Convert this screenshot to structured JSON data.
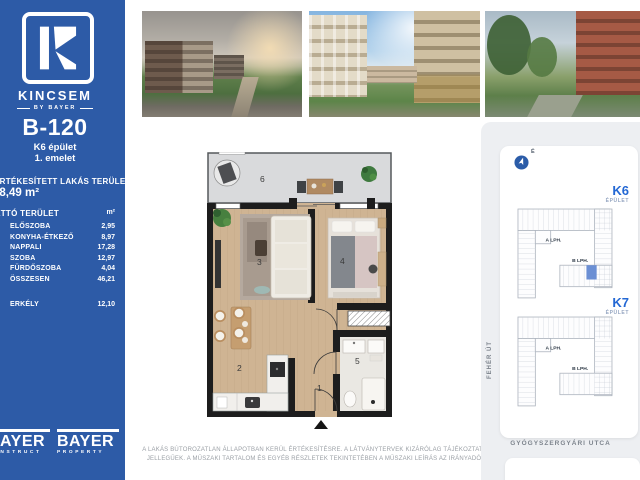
{
  "colors": {
    "sidebar_blue": "#2d5ba7",
    "accent_blue": "#2468d4",
    "unit_highlight": "#6b8fd4",
    "panel_gray": "#edeff2",
    "wall_black": "#1d1d1d",
    "wood_floor": "#cfb493"
  },
  "sidebar": {
    "logo_letter": "K",
    "brand_name": "KINCSEM",
    "brand_tagline": "BY BAYER",
    "unit_id": "B-120",
    "building": "K6 épület",
    "floor": "1. emelet",
    "sold_area_label": "ÉRTÉKESÍTETT LAKÁS TERÜLET",
    "sold_area_value": "48,49 m²",
    "net_table": {
      "header_label": "NETTÓ TERÜLET",
      "header_unit": "m²",
      "rows": [
        {
          "label": "ELŐSZOBA",
          "value": "2,95"
        },
        {
          "label": "KONYHA-ÉTKEZŐ",
          "value": "8,97"
        },
        {
          "label": "NAPPALI",
          "value": "17,28"
        },
        {
          "label": "SZOBA",
          "value": "12,97"
        },
        {
          "label": "FÜRDŐSZOBA",
          "value": "4,04"
        },
        {
          "label": "ÖSSZESEN",
          "value": "46,21"
        },
        {
          "label": "ERKÉLY",
          "value": "12,10"
        }
      ]
    },
    "partner_logos": [
      {
        "name": "BAYER",
        "division": "CONSTRUCT"
      },
      {
        "name": "BAYER",
        "division": "PROPERTY"
      }
    ]
  },
  "gallery": {
    "photos": [
      {
        "name": "park-avenue-render"
      },
      {
        "name": "courtyard-render"
      },
      {
        "name": "street-render"
      }
    ]
  },
  "floor_plan": {
    "rooms": {
      "hall": "1",
      "kitchen_dining": "2",
      "living": "3",
      "bedroom": "4",
      "bathroom": "5",
      "balcony": "6"
    }
  },
  "site_map": {
    "north_label": "É",
    "buildings": [
      {
        "id": "K6",
        "type": "ÉPÜLET",
        "stairwell_a": "A LPH.",
        "stairwell_b": "B LPH.",
        "highlighted": true
      },
      {
        "id": "K7",
        "type": "ÉPÜLET",
        "stairwell_a": "A LPH.",
        "stairwell_b": "B LPH.",
        "highlighted": false
      }
    ],
    "street_left": "FEHÉR ÚT",
    "street_bottom": "GYÓGYSZERGYÁRI UTCA"
  },
  "disclaimer": {
    "line1": "A LAKÁS BÚTOROZATLAN ÁLLAPOTBAN KERÜL ÉRTÉKESÍTÉSRE. A LÁTVÁNYTERVEK KIZÁRÓLAG TÁJÉKOZTATÓ",
    "line2": "JELLEGŰEK. A MŰSZAKI TARTALOM ÉS EGYÉB RÉSZLETEK TEKINTETÉBEN A MŰSZAKI LEÍRÁS AZ IRÁNYADÓ."
  }
}
